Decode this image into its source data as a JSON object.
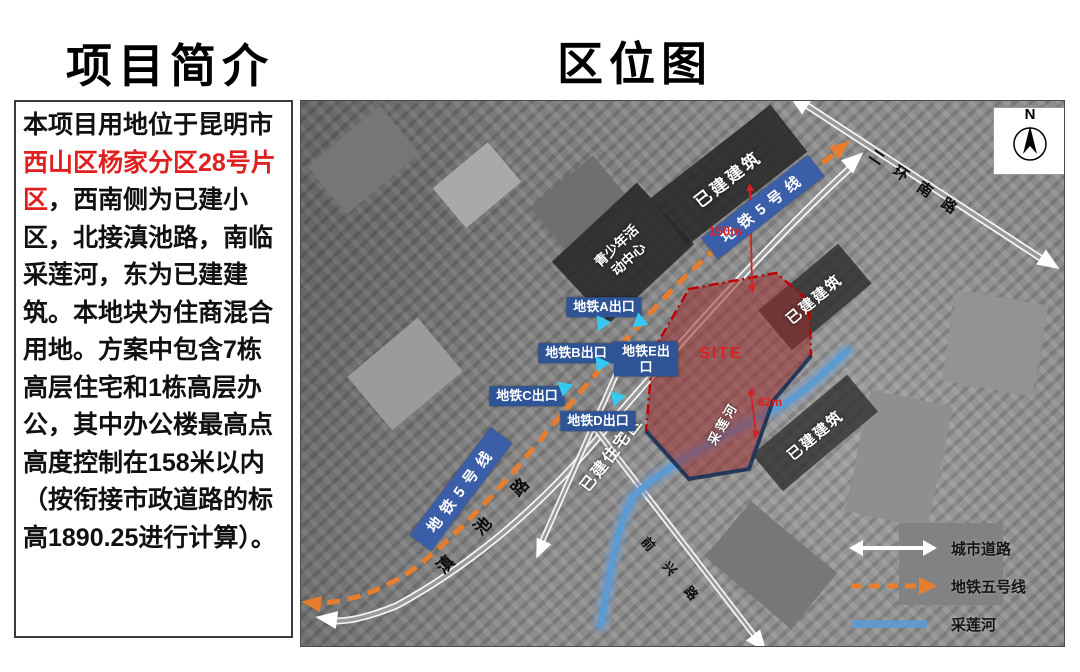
{
  "titles": {
    "project": "项目简介",
    "map": "区位图"
  },
  "intro": {
    "pre": "本项目用地位于昆明市",
    "highlight": "西山区杨家分区28号片区",
    "post": "，西南侧为已建小区，北接滇池路，南临采莲河，东为已建建筑。本地块为住商混合用地。方案中包含7栋高层住宅和1栋高层办公，其中办公楼最高点高度控制在158米以内（按衔接市政道路的标高1890.25进行计算）。"
  },
  "map": {
    "compass": "N",
    "roads": {
      "erhuannanlu": "二环南路",
      "dianchilu": "滇 池 路",
      "qianxinglu": "前 兴 路"
    },
    "metro": {
      "banner_top": "地铁5号线",
      "banner_bottom": "地铁5号线"
    },
    "exits": {
      "a": "地铁A出口",
      "b": "地铁B出口",
      "c": "地铁C出口",
      "d": "地铁D出口",
      "e": "地铁E出口"
    },
    "labels": {
      "youth_center": "青少年活动中心",
      "built_top": "已建建筑",
      "built_right_upper": "已建建筑",
      "built_right_lower": "已建建筑",
      "residential": "已建住宅区",
      "river": "采莲河",
      "site": "SITE"
    },
    "dimensions": {
      "north": "150m",
      "south": "62m"
    },
    "legend": {
      "road": "城市道路",
      "metro": "地铁五号线",
      "river": "采莲河"
    },
    "colors": {
      "metro_line": "#e87e2d",
      "river": "#5b9bd5",
      "site_fill": "rgba(155,45,45,0.55)",
      "site_border": "#c00000",
      "exit_bg": "#2f5496",
      "exit_marker": "#35c8f0",
      "highlight_text": "#e02020"
    }
  }
}
